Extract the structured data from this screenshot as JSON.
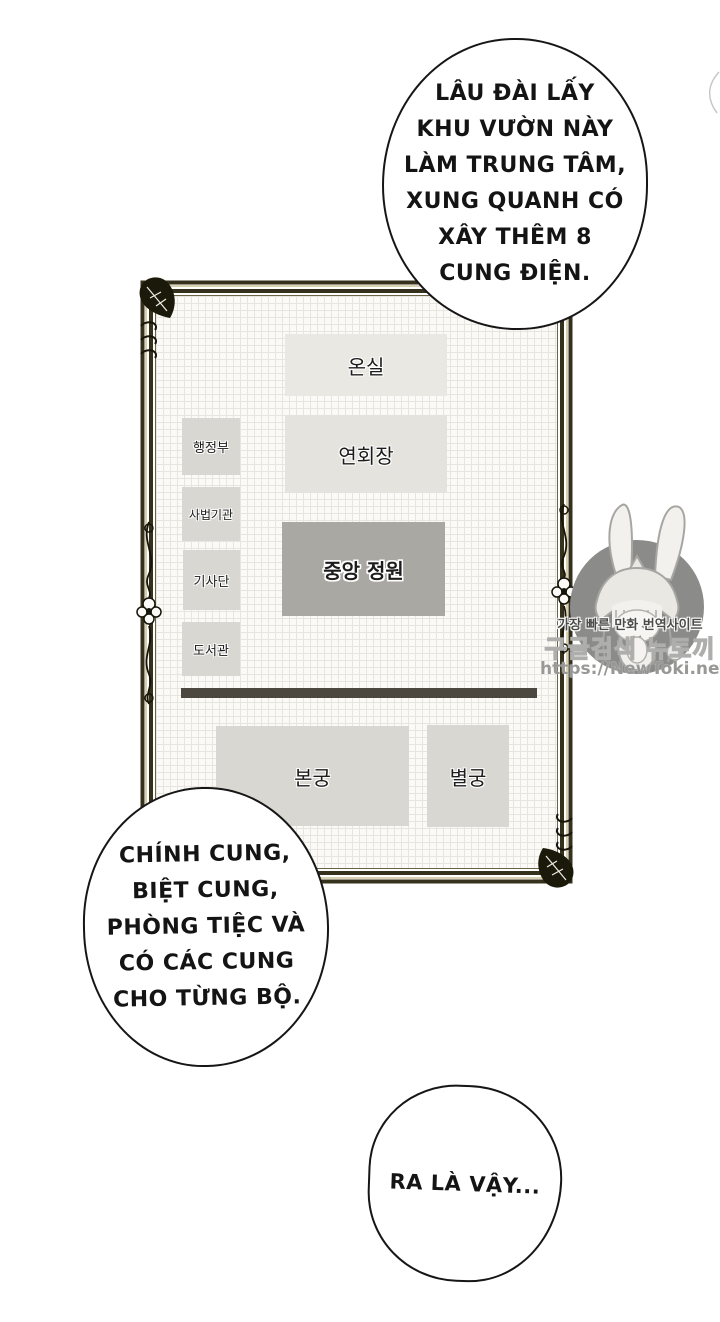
{
  "speech_bubbles": {
    "top": {
      "lines": [
        "LÂU ĐÀI LẤY",
        "KHU VƯỜN NÀY",
        "LÀM TRUNG TÂM,",
        "XUNG QUANH CÓ",
        "XÂY THÊM 8",
        "CUNG ĐIỆN."
      ]
    },
    "bottom_left": {
      "lines": [
        "CHÍNH CUNG,",
        "BIỆT CUNG,",
        "PHÒNG TIỆC VÀ",
        "CÓ CÁC CUNG",
        "CHO TỪNG BỘ."
      ]
    },
    "bottom_right": {
      "lines": [
        "RA LÀ VẬY..."
      ]
    }
  },
  "palace_map": {
    "rooms": [
      {
        "label": "온실"
      },
      {
        "label": "행정부"
      },
      {
        "label": "연회장"
      },
      {
        "label": "사법기관"
      },
      {
        "label": "기사단"
      },
      {
        "label": "중앙 정원"
      },
      {
        "label": "도서관"
      },
      {
        "label": "본궁"
      },
      {
        "label": "별궁"
      }
    ]
  },
  "watermark": {
    "tagline": "가장 빠른 만화 번역사이트",
    "site_name": "구글검색 뉴토끼",
    "url": "https://NewToki.net"
  },
  "colors": {
    "frame_dark": "#35311d",
    "frame_gold": "#cfc49b",
    "map_background": "#fbfaf7",
    "grid_line": "#e7e5df",
    "room_light": "#e9e8e3",
    "room_mid": "#d8d7d2",
    "room_dark": "#a9a8a3",
    "separator_bar": "#4c483f",
    "watermark_circle": "#8b8b89",
    "bubble_stroke": "#161616"
  }
}
